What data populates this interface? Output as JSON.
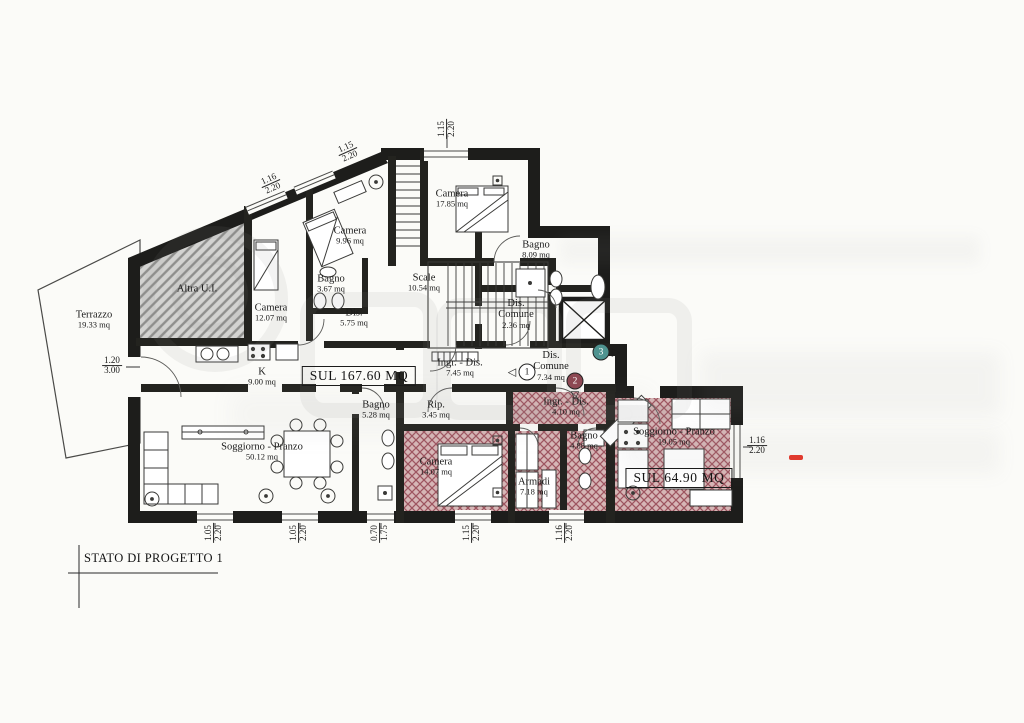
{
  "title_block": {
    "text": "STATO DI PROGETTO 1"
  },
  "colors": {
    "wall": "#1d1d1b",
    "paper": "#fbfbf8",
    "red_hatch_line": "#9e5560",
    "red_hatch_fill": "#d6b6b6",
    "gray_hatch_line": "#8f8f8d",
    "gray_hatch_fill": "#d3d3d1",
    "watermark_gray": "#8a8a8a",
    "accent_red": "#e03a2e"
  },
  "sul_labels": [
    {
      "text": "SUL 167.60 MQ",
      "x": 359,
      "y": 376
    },
    {
      "text": "SUL 64.90 MQ",
      "x": 679,
      "y": 478
    }
  ],
  "rooms": [
    {
      "name": "Terrazzo",
      "area": "19.33 mq",
      "x": 94,
      "y": 320
    },
    {
      "name": "Altra U.I.",
      "area": "",
      "x": 197,
      "y": 289
    },
    {
      "name": "Camera",
      "area": "9.96 mq",
      "x": 350,
      "y": 236
    },
    {
      "name": "Bagno",
      "area": "3.67 mq",
      "x": 331,
      "y": 284
    },
    {
      "name": "Camera",
      "area": "12.07 mq",
      "x": 271,
      "y": 313
    },
    {
      "name": "Dis.",
      "area": "5.75 mq",
      "x": 354,
      "y": 318
    },
    {
      "name": "Camera",
      "area": "17.85 mq",
      "x": 452,
      "y": 199
    },
    {
      "name": "Scale",
      "area": "10.54 mq",
      "x": 424,
      "y": 283
    },
    {
      "name": "Bagno",
      "area": "8.09 mq",
      "x": 536,
      "y": 250
    },
    {
      "name": "Dis.\nComune",
      "area": "2.36 mq",
      "x": 516,
      "y": 314
    },
    {
      "name": "Dis.\nComune",
      "area": "7.34 mq",
      "x": 551,
      "y": 366
    },
    {
      "name": "K",
      "area": "9.00 mq",
      "x": 262,
      "y": 377
    },
    {
      "name": "Ingr. - Dis.",
      "area": "7.45 mq",
      "x": 460,
      "y": 368
    },
    {
      "name": "Bagno",
      "area": "5.28 mq",
      "x": 376,
      "y": 410
    },
    {
      "name": "Rip.",
      "area": "3.45 mq",
      "x": 436,
      "y": 410
    },
    {
      "name": "Soggiorno - Pranzo",
      "area": "50.12 mq",
      "x": 262,
      "y": 452
    },
    {
      "name": "Camera",
      "area": "14.07 mq",
      "x": 436,
      "y": 467
    },
    {
      "name": "Ingr. - Dis.",
      "area": "4.10 mq",
      "x": 566,
      "y": 407
    },
    {
      "name": "Armadi",
      "area": "7.18 mq",
      "x": 534,
      "y": 487
    },
    {
      "name": "Bagno",
      "area": "4.88 mq",
      "x": 584,
      "y": 441
    },
    {
      "name": "Soggiorno - Pranzo",
      "area": "19.05 mq",
      "x": 674,
      "y": 437
    }
  ],
  "dimensions": [
    {
      "a": "1.20",
      "b": "3.00",
      "x": 112,
      "y": 366,
      "rot": 0
    },
    {
      "a": "1.15",
      "b": "2.20",
      "x": 447,
      "y": 129,
      "rot": -90
    },
    {
      "a": "1.16",
      "b": "2.20",
      "x": 271,
      "y": 184,
      "rot": -24
    },
    {
      "a": "1.15",
      "b": "2.20",
      "x": 348,
      "y": 152,
      "rot": -24
    },
    {
      "a": "1.05",
      "b": "2.20",
      "x": 214,
      "y": 533,
      "rot": -90
    },
    {
      "a": "1.05",
      "b": "2.20",
      "x": 299,
      "y": 533,
      "rot": -90
    },
    {
      "a": "0.70",
      "b": "1.75",
      "x": 380,
      "y": 533,
      "rot": -90
    },
    {
      "a": "1.15",
      "b": "2.20",
      "x": 472,
      "y": 533,
      "rot": -90
    },
    {
      "a": "1.16",
      "b": "2.20",
      "x": 565,
      "y": 533,
      "rot": -90
    },
    {
      "a": "1.16",
      "b": "2.20",
      "x": 757,
      "y": 446,
      "rot": 0
    }
  ],
  "markers": [
    {
      "label": "1",
      "x": 527,
      "y": 372,
      "fill": "#ffffff",
      "text_color": "#1a1a1a",
      "arrow": "left"
    },
    {
      "label": "2",
      "x": 575,
      "y": 381,
      "fill": "#8d4853",
      "text_color": "#ffffff",
      "arrow": "down"
    },
    {
      "label": "3",
      "x": 601,
      "y": 352,
      "fill": "#4f9390",
      "text_color": "#ffffff",
      "arrow": "right"
    }
  ],
  "annotations": {
    "red_dash": {
      "x": 789,
      "y": 455,
      "color": "#e03a2e"
    }
  }
}
